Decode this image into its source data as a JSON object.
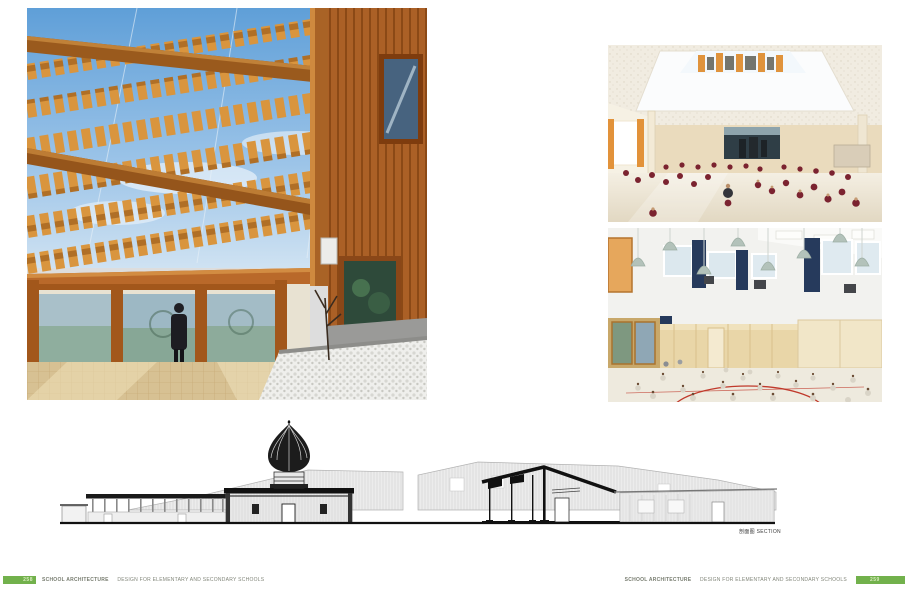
{
  "meta": {
    "accent_green": "#72b14c",
    "background": "#ffffff",
    "drawing_ink": "#111111"
  },
  "section_drawing": {
    "label_zh": "剖面图",
    "label_en": "SECTION"
  },
  "footer": {
    "left": {
      "page_number": "258",
      "title": "SCHOOL ARCHITECTURE",
      "subtitle": "DESIGN FOR ELEMENTARY AND SECONDARY SCHOOLS"
    },
    "right": {
      "page_number": "259",
      "title": "SCHOOL ARCHITECTURE",
      "subtitle": "DESIGN FOR ELEMENTARY AND SECONDARY SCHOOLS"
    }
  }
}
